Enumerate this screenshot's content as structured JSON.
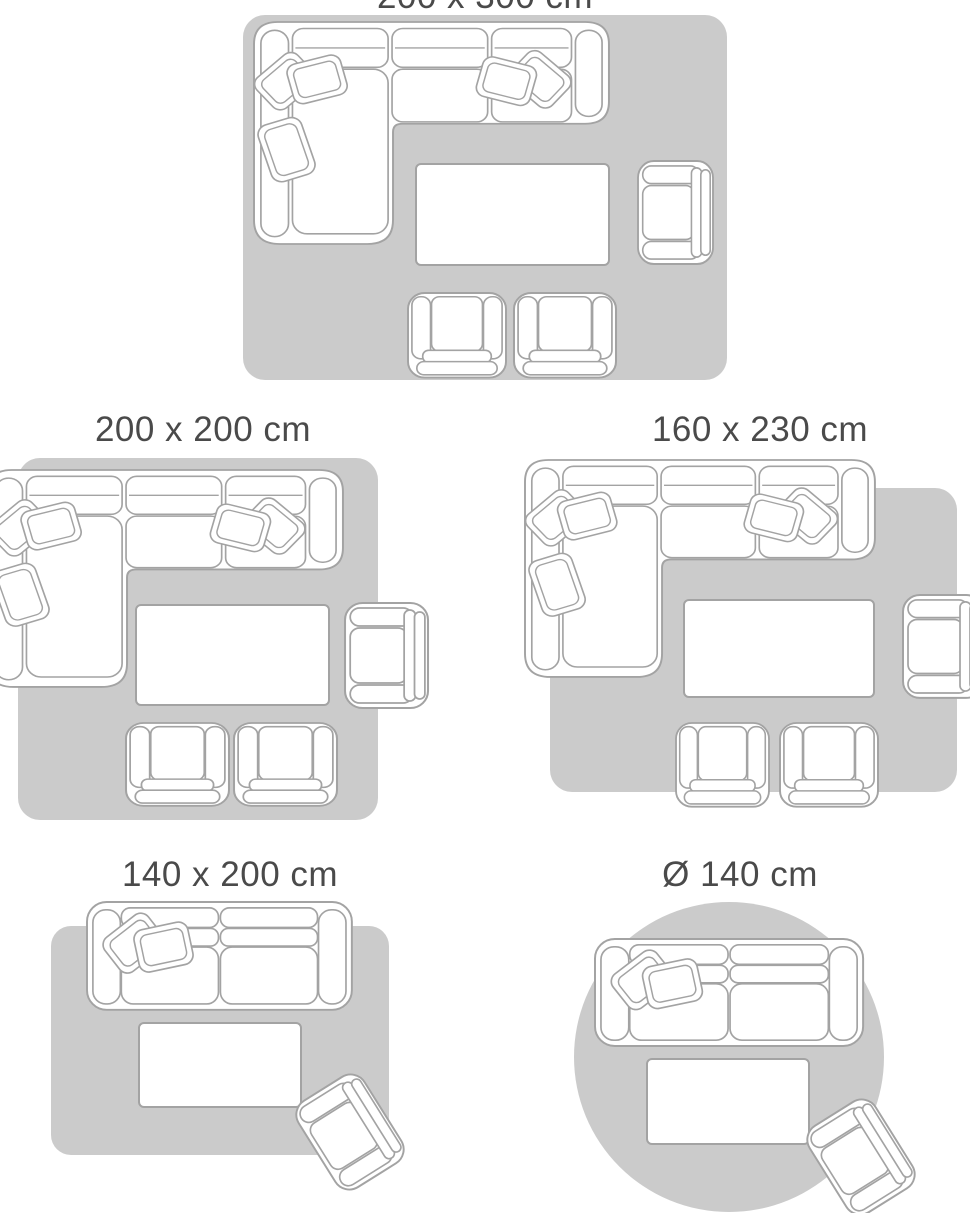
{
  "canvas": {
    "width": 970,
    "height": 1213,
    "background": "#ffffff"
  },
  "colors": {
    "rug_fill": "#cbcbcb",
    "furniture_fill": "#ffffff",
    "furniture_outline": "#a3a3a3",
    "label_text": "#4a4a4a"
  },
  "size_guide": {
    "layouts": [
      {
        "id": "rug-200x300",
        "label": "200 x 300 cm",
        "rug_shape": "rectangle"
      },
      {
        "id": "rug-200x200",
        "label": "200 x 200 cm",
        "rug_shape": "square"
      },
      {
        "id": "rug-160x230",
        "label": "160 x 230 cm",
        "rug_shape": "rectangle"
      },
      {
        "id": "rug-140x200",
        "label": "140 x 200 cm",
        "rug_shape": "rectangle"
      },
      {
        "id": "rug-diameter-140",
        "label": "Ø 140 cm",
        "rug_shape": "circle"
      }
    ]
  }
}
